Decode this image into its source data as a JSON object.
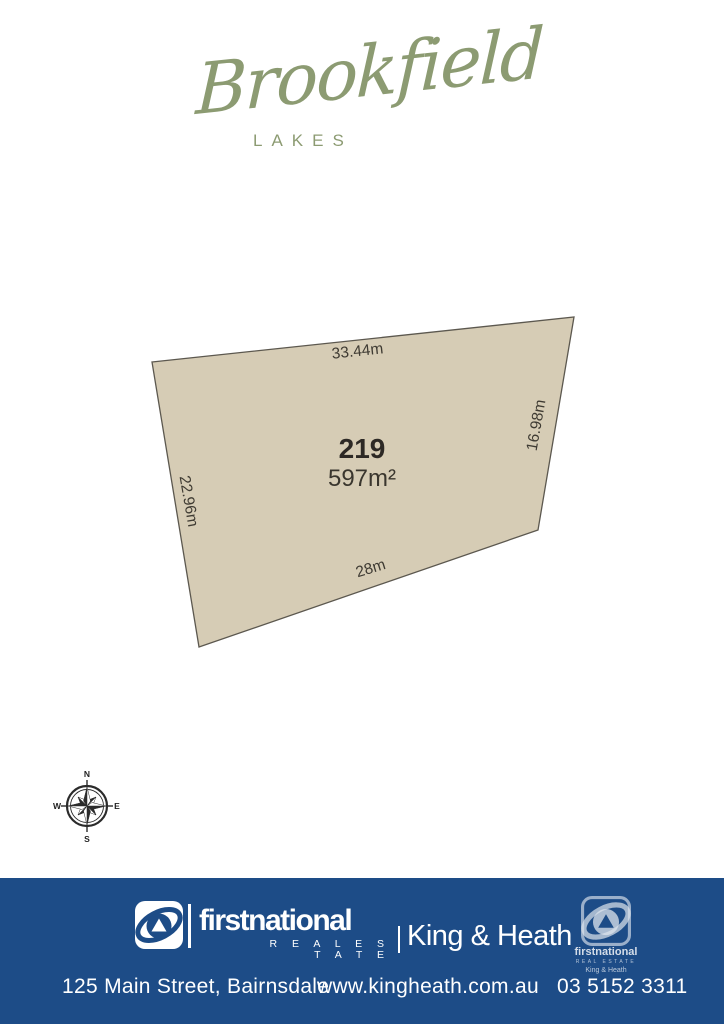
{
  "brand": {
    "name": "Brookfield",
    "subtitle": "LAKES",
    "color": "#8c9b72"
  },
  "lot": {
    "number": "219",
    "area": "597m²",
    "dimensions": {
      "top": "33.44m",
      "right": "16.98m",
      "bottom": "28m",
      "left": "22.96m"
    },
    "fill_color": "#d6ccb5",
    "outline_color": "#5c584f"
  },
  "compass": {
    "north": "N",
    "east": "E",
    "south": "S",
    "west": "W"
  },
  "footer": {
    "background_color": "#1d4c87",
    "text_color": "#ffffff",
    "brand": {
      "name": "firstnational",
      "tagline": "R E A L   E S T A T E",
      "agency": "King & Heath"
    },
    "watermark": {
      "name": "firstnational",
      "tagline": "REAL ESTATE",
      "agency": "King & Heath"
    },
    "address": "125 Main Street, Bairnsdale",
    "website": "www.kingheath.com.au",
    "phone": "03 5152 3311"
  }
}
